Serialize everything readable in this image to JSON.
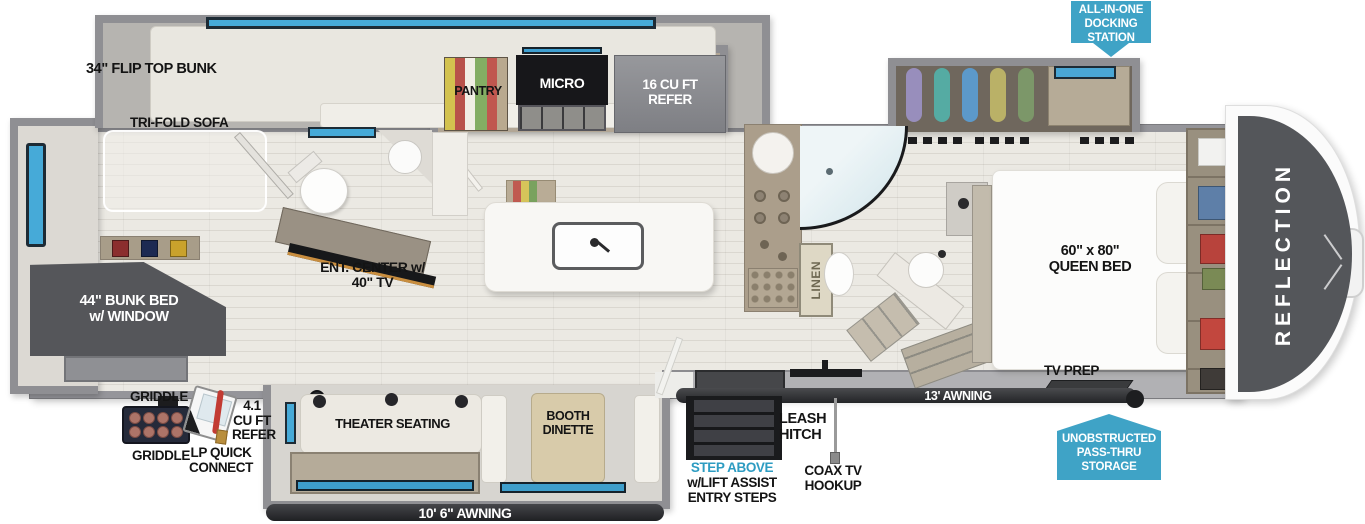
{
  "brand": "REFLECTION",
  "banners": {
    "docking_station": {
      "line1": "ALL-IN-ONE",
      "line2": "DOCKING",
      "line3": "STATION"
    },
    "pass_thru": {
      "line1": "UNOBSTRUCTED",
      "line2": "PASS-THRU",
      "line3": "STORAGE"
    }
  },
  "rooms": {
    "bunk_room": {
      "flip_top_bunk": "34\" FLIP TOP BUNK",
      "tri_fold_sofa": "TRI-FOLD SOFA",
      "bunk_bed": {
        "line1": "44\" BUNK BED",
        "line2": "w/ WINDOW"
      },
      "ent_center": {
        "line1": "ENT. CENTER w/",
        "line2": "40\" TV"
      }
    },
    "kitchen": {
      "pantry": "PANTRY",
      "micro": "MICRO",
      "refer": {
        "line1": "16 CU FT",
        "line2": "REFER"
      }
    },
    "living": {
      "theater_seating": "THEATER SEATING",
      "booth_dinette": {
        "line1": "BOOTH",
        "line2": "DINETTE"
      }
    },
    "bath": {
      "linen": "LINEN"
    },
    "bedroom": {
      "queen_bed": {
        "line1": "60\" x 80\"",
        "line2": "QUEEN BED"
      },
      "tv_prep": "TV PREP"
    }
  },
  "exterior": {
    "awning_main": "10' 6\" AWNING",
    "awning_front": "13' AWNING",
    "leash_hitch": {
      "line1": "LEASH",
      "line2": "HITCH"
    },
    "entry_steps": {
      "highlight": "STEP ABOVE",
      "line2": "w/LIFT ASSIST",
      "line3": "ENTRY STEPS"
    },
    "coax": {
      "line1": "COAX TV",
      "line2": "HOOKUP"
    },
    "griddle_label_top": "GRIDDLE",
    "griddle_label_bottom": "GRIDDLE",
    "outside_refer": {
      "line1": "4.1",
      "line2": "CU FT",
      "line3": "REFER"
    },
    "lp_quick_connect": {
      "line1": "LP QUICK",
      "line2": "CONNECT"
    }
  },
  "colors": {
    "callout_blue": "#3fa3c6",
    "highlight_text_blue": "#2d9cc2",
    "window_blue": "#46aad8",
    "front_cap_gray": "#54565a",
    "awning_dark": "#2e2f32",
    "wall_gray": "#8f8f93",
    "floor_light": "#eae8e2"
  }
}
